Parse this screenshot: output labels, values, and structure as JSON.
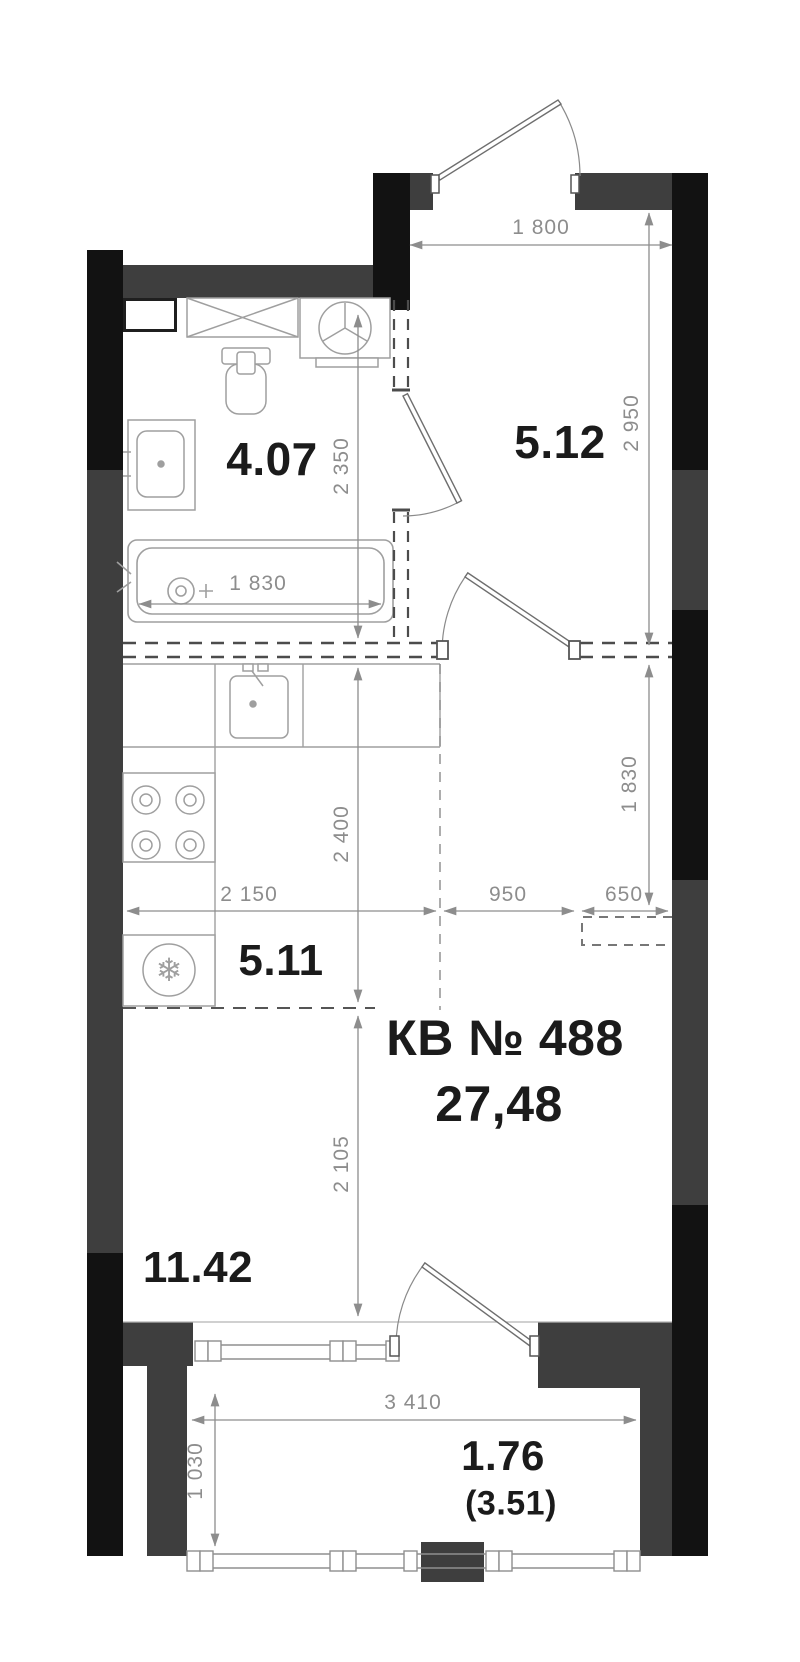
{
  "apartment": {
    "label": "КВ № 488",
    "area": "27,48"
  },
  "rooms": [
    {
      "id": "bathroom",
      "label": "4.07"
    },
    {
      "id": "hallway",
      "label": "5.12"
    },
    {
      "id": "kitchen",
      "label": "5.11"
    },
    {
      "id": "living",
      "label": "11.42"
    },
    {
      "id": "balcony",
      "label": "1.76",
      "label_total": "(3.51)"
    }
  ],
  "dims": {
    "entry_width": "1 800",
    "hall_depth": "2 950",
    "bath_depth": "2 350",
    "bathtub": "1 830",
    "kitchen_depth": "2 400",
    "closet_depth": "1 830",
    "kitchen_width": "2 150",
    "door_zone": "950",
    "closet_width": "650",
    "living_depth": "2 105",
    "balcony_width": "3 410",
    "balcony_depth": "1 030"
  },
  "icons": {
    "fridge_glyph": "❄"
  },
  "colors": {
    "wall_dark": "#3e3e3e",
    "wall_black": "#121212",
    "lines": "#9f9f9f",
    "dim_text": "#8d8d8d",
    "label_text": "#1b1b1b",
    "background": "#ffffff"
  }
}
